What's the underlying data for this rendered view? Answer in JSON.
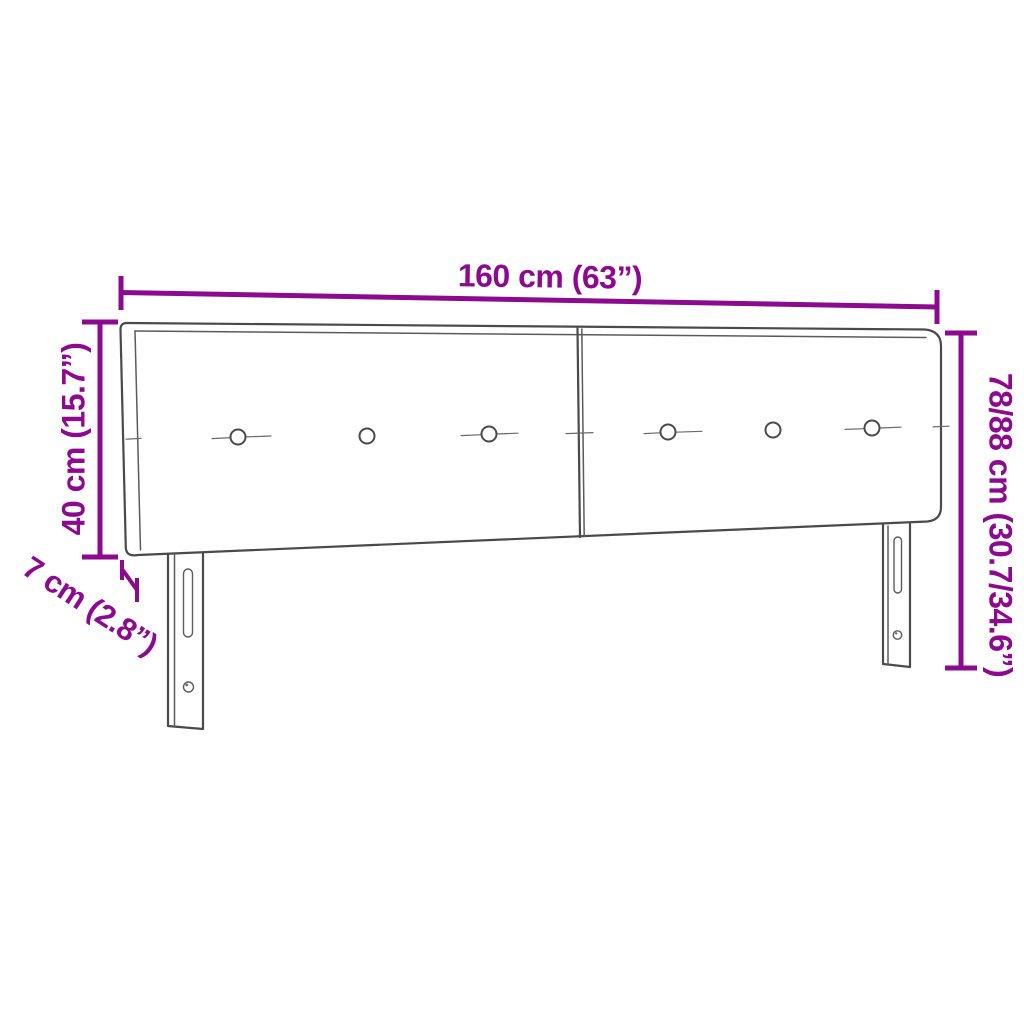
{
  "diagram": {
    "accent_color": "#8B0A8E",
    "drawing_color": "#4a4a4a",
    "labels": {
      "width": "160 cm (63”)",
      "panel_height": "40 cm (15.7”)",
      "depth": "7 cm (2.8”)",
      "total_height": "78/88 cm (30.7/34.6”)"
    }
  }
}
